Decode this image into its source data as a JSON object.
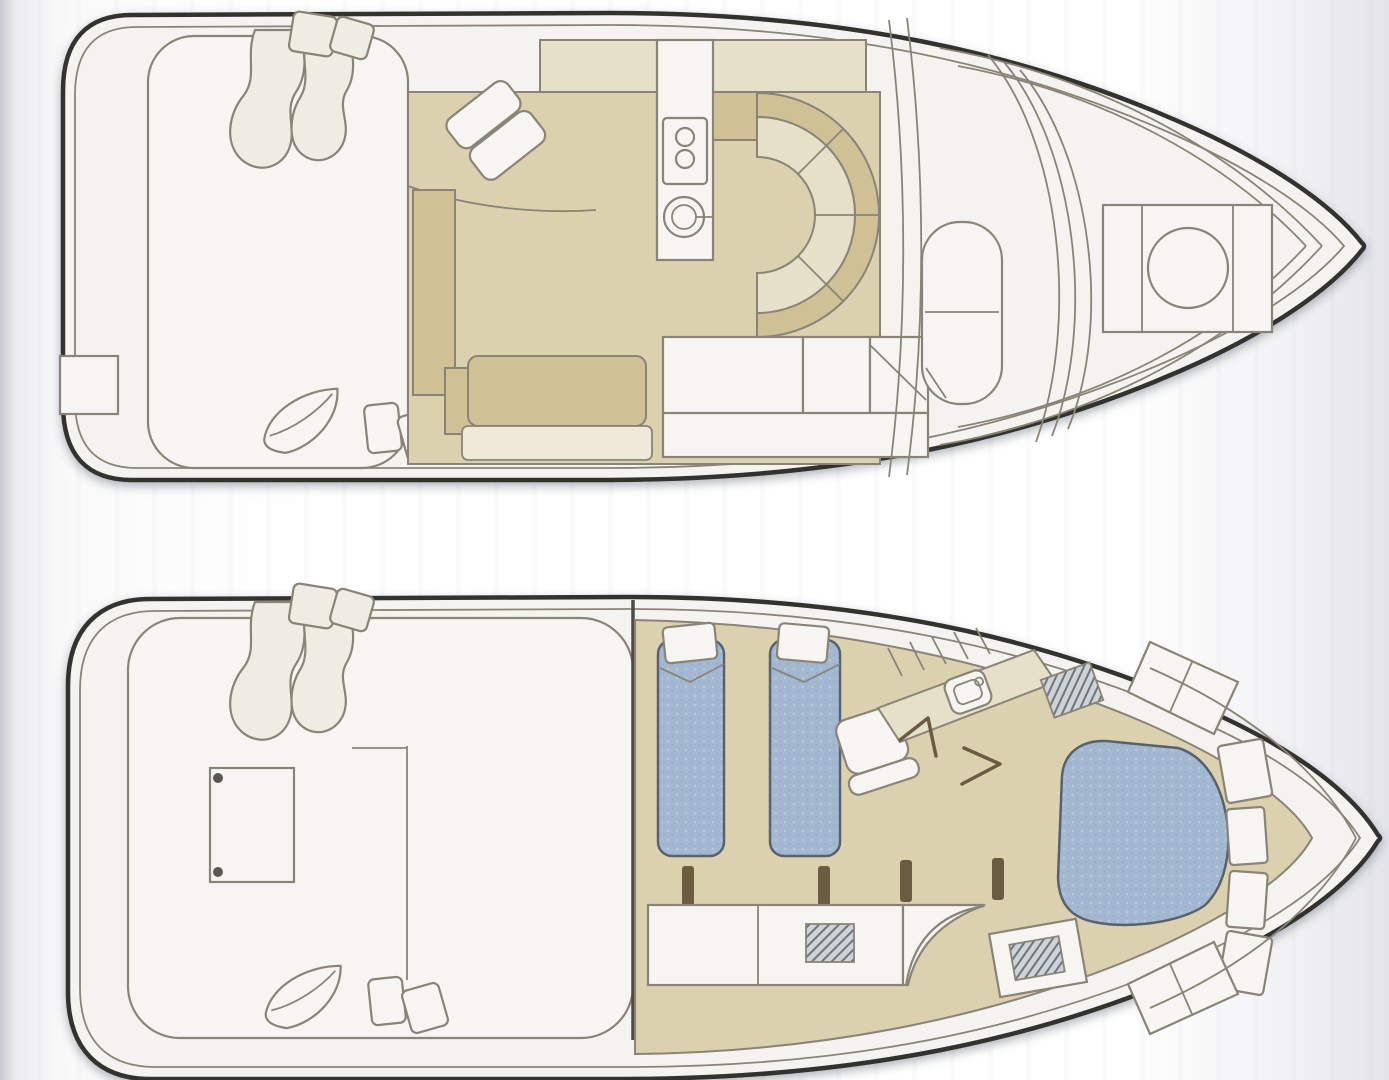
{
  "figure": {
    "type": "yacht-floorplan-diagram",
    "title": "Motor yacht two-deck floor plan, bow facing right",
    "orientation": "bow-right",
    "decks": [
      {
        "id": "main-deck",
        "label": "Main deck / bridge plan",
        "areas": [
          "swim platform step",
          "aft cockpit",
          "helm wave seats",
          "helm chair",
          "salon floor",
          "salon sofa",
          "side cabinet",
          "galley stove with two burners",
          "round galley sink",
          "curved U-shaped dinette booth",
          "white bench seating",
          "companionway steps",
          "windshield arcs",
          "foredeck walkway",
          "bow hatch with round port"
        ]
      },
      {
        "id": "lower-deck",
        "label": "Lower deck / accommodation plan",
        "areas": [
          "aft cockpit",
          "wave seats",
          "engine hatch with hinges",
          "cockpit partition",
          "guest cabin with twin berths and pillows",
          "cabin chair",
          "doorway posts",
          "galley counters",
          "vent grilles",
          "curved stair",
          "head vanity with sink",
          "shower grate",
          "door swings",
          "companionway steps",
          "forward master cabin island berth",
          "bow cabinetry band",
          "transom locker"
        ]
      }
    ]
  },
  "colors": {
    "bg_edge": "#c9c9d3",
    "bg_mid": "#ffffff",
    "hull_line": "#33312e",
    "line": "#8a8478",
    "line_soft": "#a39d90",
    "deck_white": "#f6f5f1",
    "deck_warm": "#efece4",
    "tan": "#dbd1af",
    "tan_dark": "#cfc096",
    "tan_light": "#e7e0c8",
    "tan_pale": "#eee9d8",
    "blue": "#a3b8d0",
    "blue_light": "#bccadd",
    "blue_outline": "#57626e",
    "post": "#6b5c41",
    "grille_bg": "#cdd3d6",
    "grille_line": "#6e757b",
    "shadow": "#555a66"
  }
}
